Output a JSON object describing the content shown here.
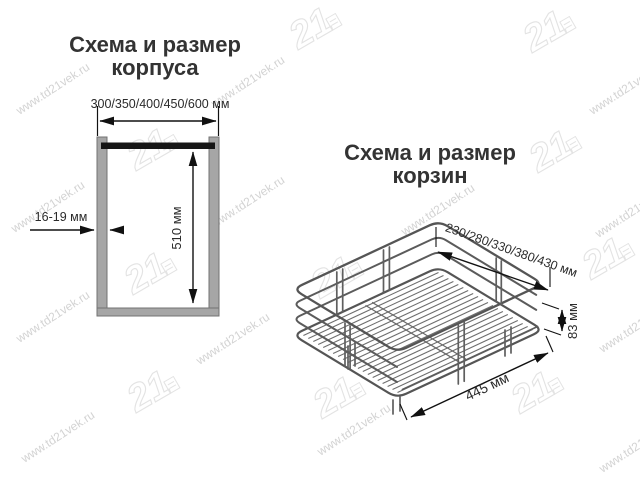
{
  "cabinet": {
    "title_line1": "Схема и размер",
    "title_line2": "корпуса",
    "width_label": "300/350/400/450/600 мм",
    "height_label": "510 мм",
    "thickness_label": "16-19 мм"
  },
  "basket": {
    "title_line1": "Схема и размер",
    "title_line2": "корзин",
    "width_label": "230/280/330/380/430 мм",
    "height_label": "83 мм",
    "depth_label": "445 мм"
  },
  "watermark": {
    "url_text": "www.td21vek.ru",
    "logo_text": "21"
  },
  "colors": {
    "dimension_line": "#111111",
    "wall_fill": "#a6a6a6",
    "wall_stroke": "#737373",
    "top_bar": "#161616",
    "wire_gray": "#5f5f5f",
    "watermark_gray": "#d3d3d3",
    "title_color": "#333333",
    "background": "#ffffff"
  }
}
